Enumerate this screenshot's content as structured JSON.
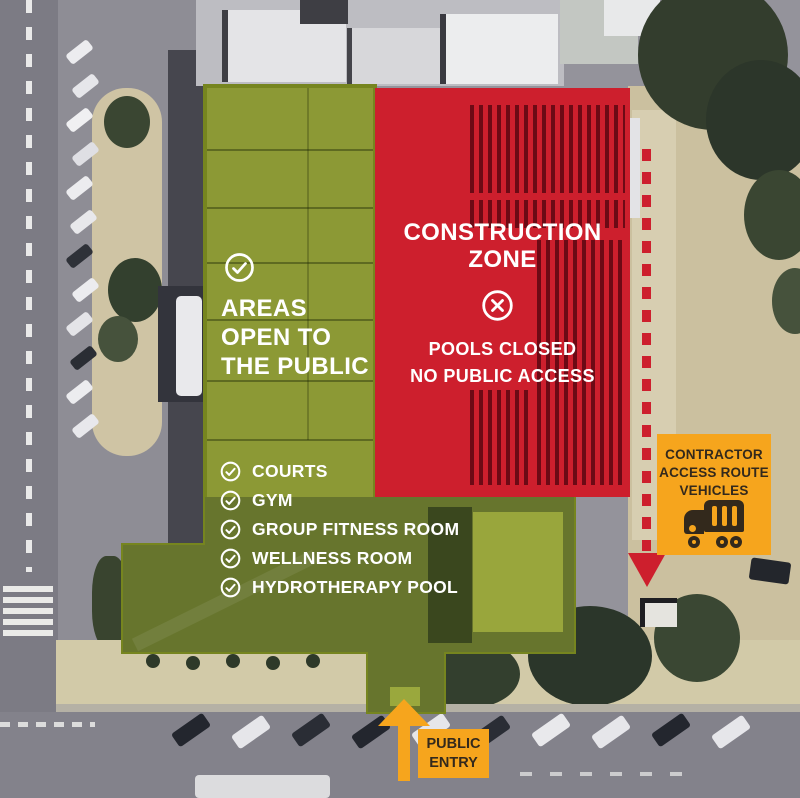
{
  "zones": {
    "open": {
      "heading": [
        "AREAS",
        "OPEN TO",
        "THE PUBLIC"
      ],
      "items": [
        "COURTS",
        "GYM",
        "GROUP FITNESS ROOM",
        "WELLNESS ROOM",
        "HYDROTHERAPY POOL"
      ],
      "color": "#8C9935",
      "icon": "check-circle"
    },
    "construction": {
      "heading": [
        "CONSTRUCTION",
        "ZONE"
      ],
      "subheading": [
        "POOLS CLOSED",
        "NO PUBLIC ACCESS"
      ],
      "color": "#CD1F2D",
      "icon": "x-circle"
    }
  },
  "callouts": {
    "contractor": {
      "lines": [
        "CONTRACTOR",
        "ACCESS ROUTE",
        "VEHICLES"
      ],
      "color": "#F6A51D",
      "icon": "truck"
    },
    "public_entry": {
      "lines": [
        "PUBLIC",
        "ENTRY"
      ],
      "color": "#F6A51D",
      "icon": "up-arrow"
    }
  }
}
